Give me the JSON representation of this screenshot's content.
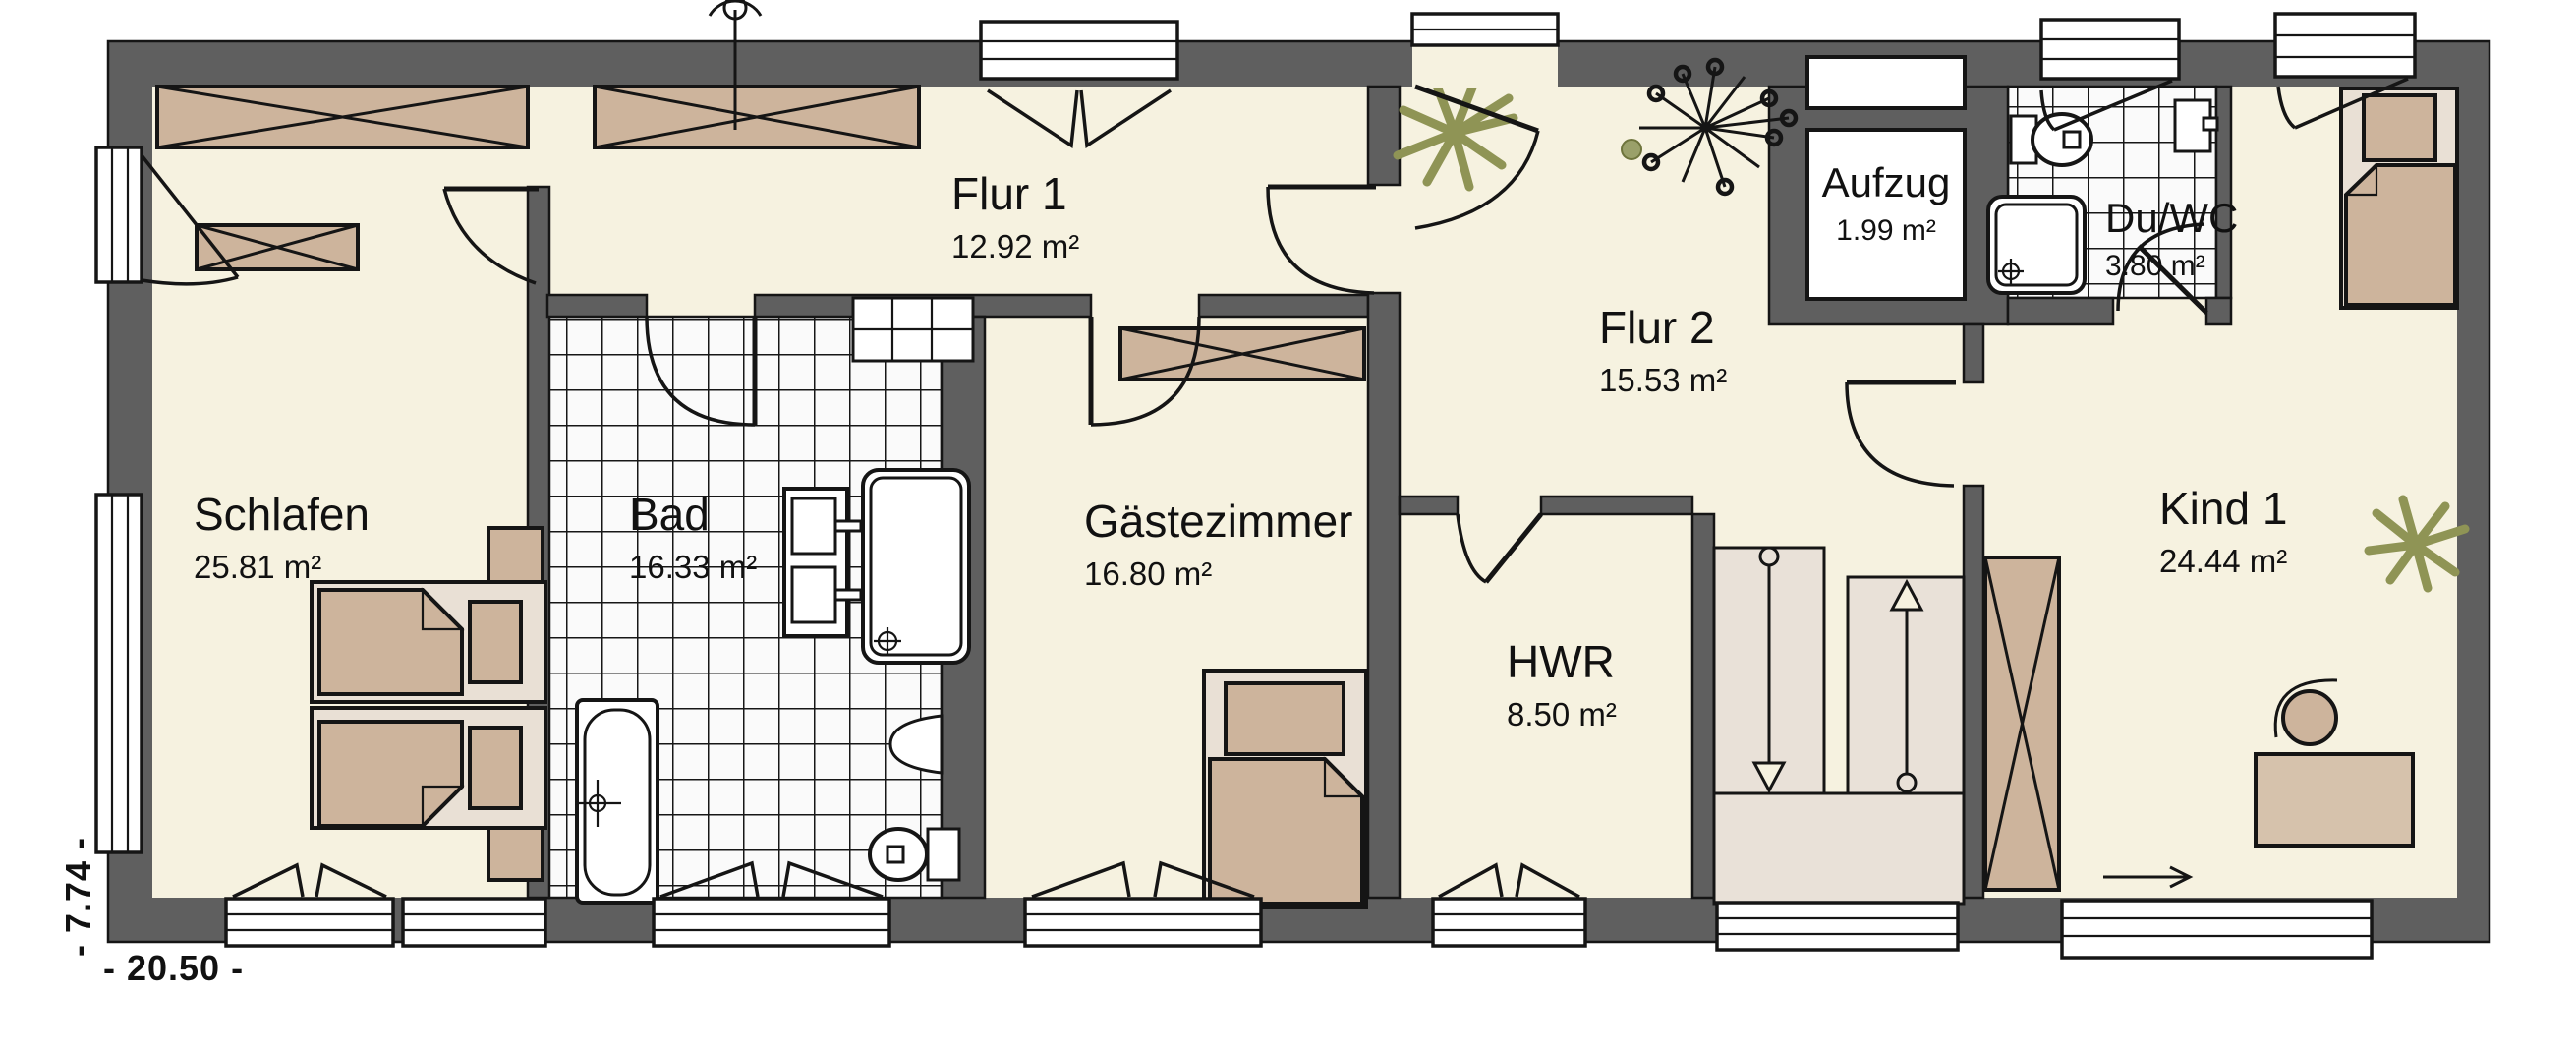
{
  "plan": {
    "rooms": [
      {
        "id": "schlafen",
        "label": "Schlafen",
        "area": "25.81 m²"
      },
      {
        "id": "flur1",
        "label": "Flur 1",
        "area": "12.92 m²"
      },
      {
        "id": "bad",
        "label": "Bad",
        "area": "16.33 m²"
      },
      {
        "id": "gaestezimmer",
        "label": "Gästezimmer",
        "area": "16.80 m²"
      },
      {
        "id": "flur2",
        "label": "Flur 2",
        "area": "15.53 m²"
      },
      {
        "id": "hwr",
        "label": "HWR",
        "area": "8.50 m²"
      },
      {
        "id": "aufzug",
        "label": "Aufzug",
        "area": "1.99 m²"
      },
      {
        "id": "duwc",
        "label": "Du/WC",
        "area": "3.80 m²"
      },
      {
        "id": "kind1",
        "label": "Kind 1",
        "area": "24.44 m²"
      }
    ],
    "dimensions": {
      "bottom": "- 20.50 -",
      "left": "- 7.74 -"
    },
    "colors": {
      "wall": "#5f5f5f",
      "floor": "#f6f2e0",
      "furniture": "#cdb49c",
      "bed_frame": "#e9e0d5",
      "stairs": "#e9e1d8",
      "plant": "#8f9455",
      "outline": "#151515",
      "background": "#ffffff"
    }
  }
}
